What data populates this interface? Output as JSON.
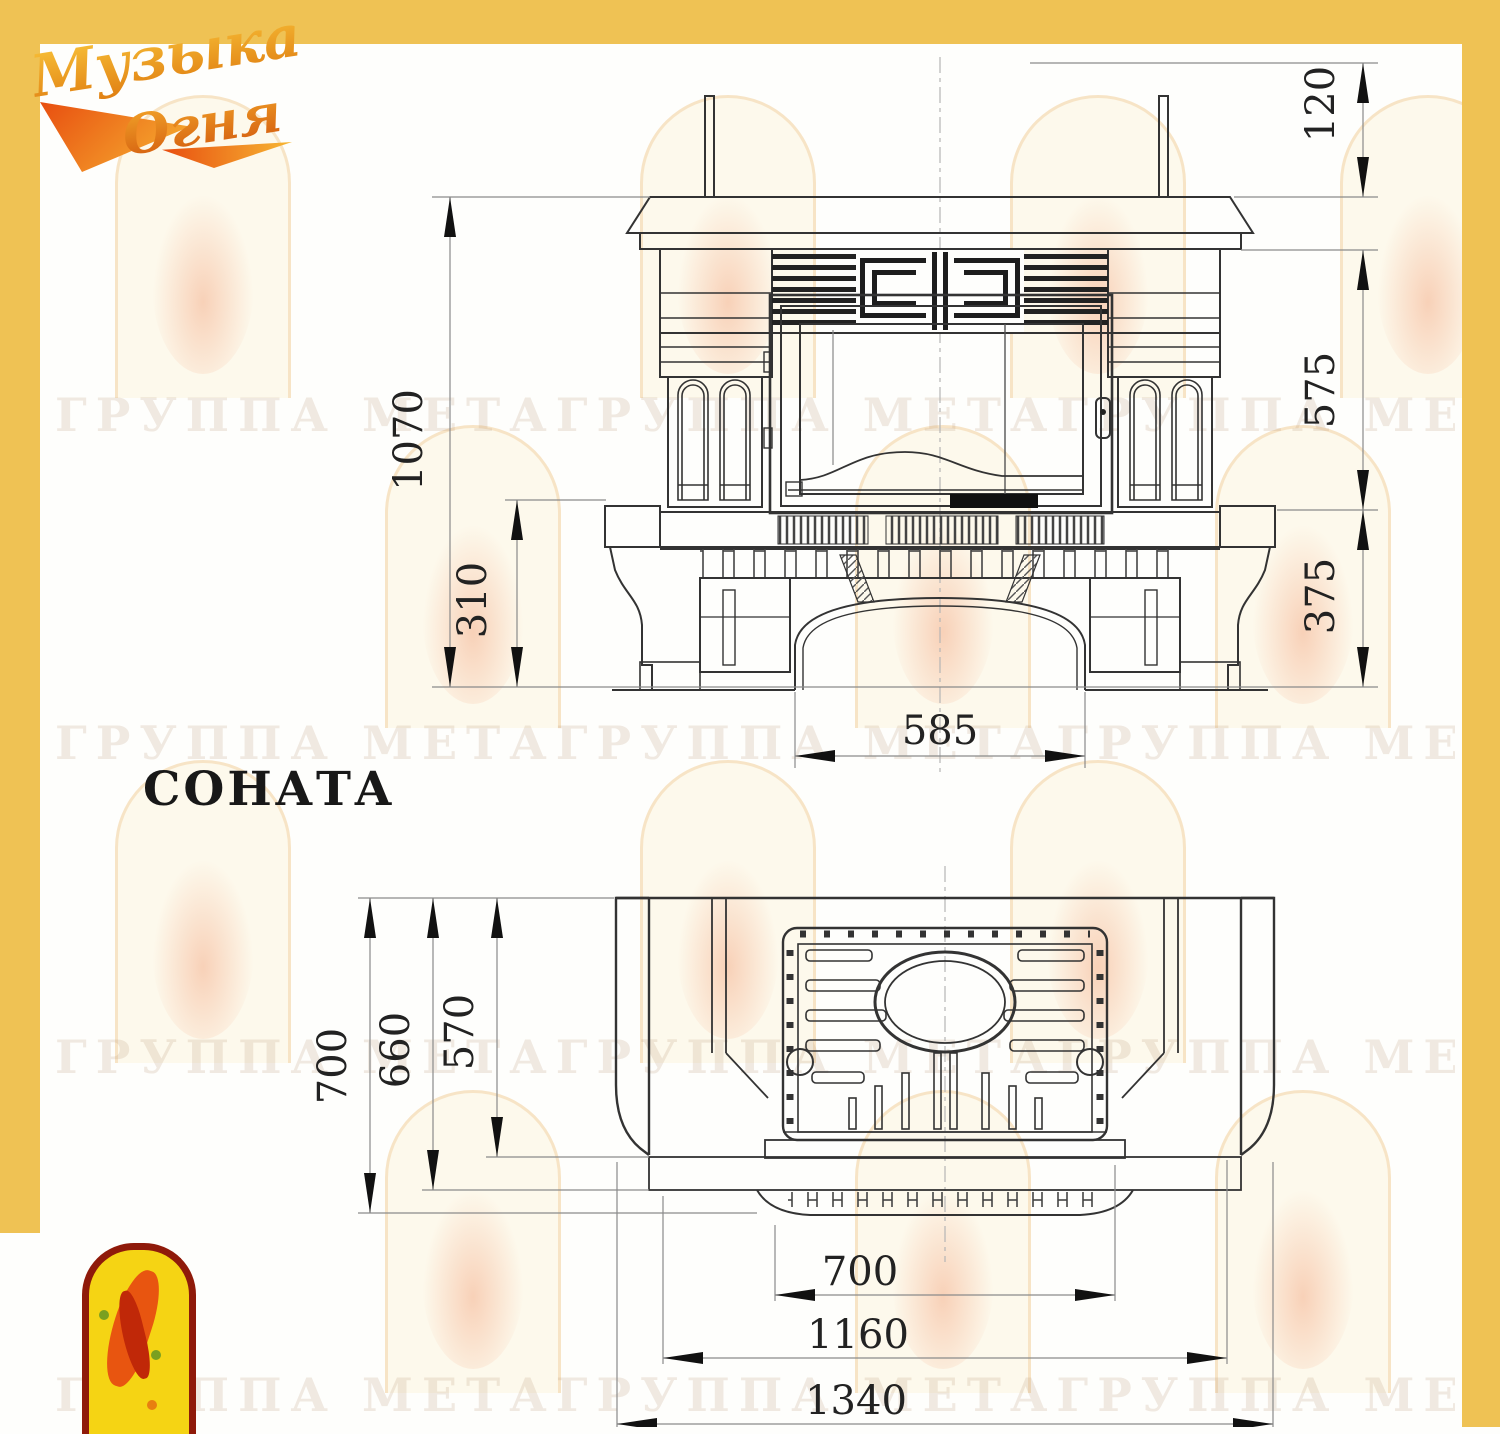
{
  "page": {
    "accent_yellow": "#efc254"
  },
  "brand_logo": {
    "line1": "Музыка",
    "line2": "Огня"
  },
  "watermark": {
    "unit": "ГРУППА МЕТА",
    "band": "ГРУППА МЕТАГРУППА МЕТАГРУППА МЕТАГРУППА МЕТАГРУППА МЕТАГРУППА МЕТА"
  },
  "model": {
    "name": "СОНАТА"
  },
  "front_view": {
    "dim_chimney_top": "120",
    "dim_portal_height": "575",
    "dim_base_height": "375",
    "dim_total_height": "1070",
    "dim_hearth_height": "310",
    "dim_arch_width": "585"
  },
  "plan_view": {
    "dim_depth_total": "700",
    "dim_depth_body": "660",
    "dim_depth_firebox": "570",
    "dim_width_opening": "700",
    "dim_width_body": "1160",
    "dim_width_total": "1340"
  }
}
